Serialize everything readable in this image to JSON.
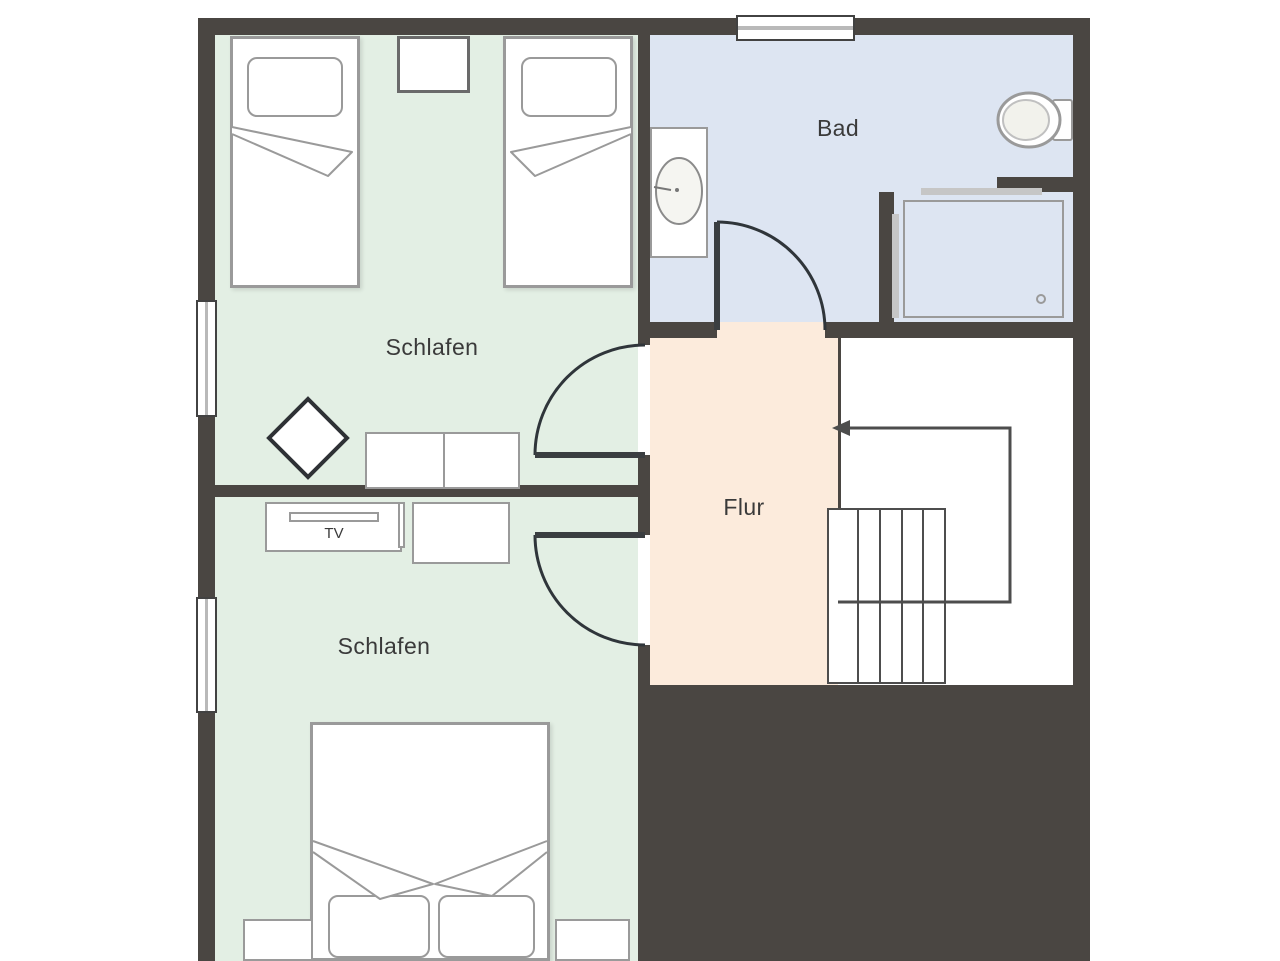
{
  "rooms": {
    "bedroom_top": {
      "label": "Schlafen"
    },
    "bedroom_bottom": {
      "label": "Schlafen"
    },
    "bathroom": {
      "label": "Bad"
    },
    "hallway": {
      "label": "Flur"
    }
  },
  "furniture": {
    "tv": {
      "label": "TV"
    }
  },
  "colors": {
    "wall": "#4a4642",
    "bedroom_floor": "#e3efe4",
    "bathroom_floor": "#dde5f2",
    "hallway_floor": "#fcebdc",
    "fixture_outline": "#9a9a9a",
    "door_line": "#2f353a",
    "stairs_line": "#4d4d4d",
    "label_text": "#3a3a3a"
  }
}
